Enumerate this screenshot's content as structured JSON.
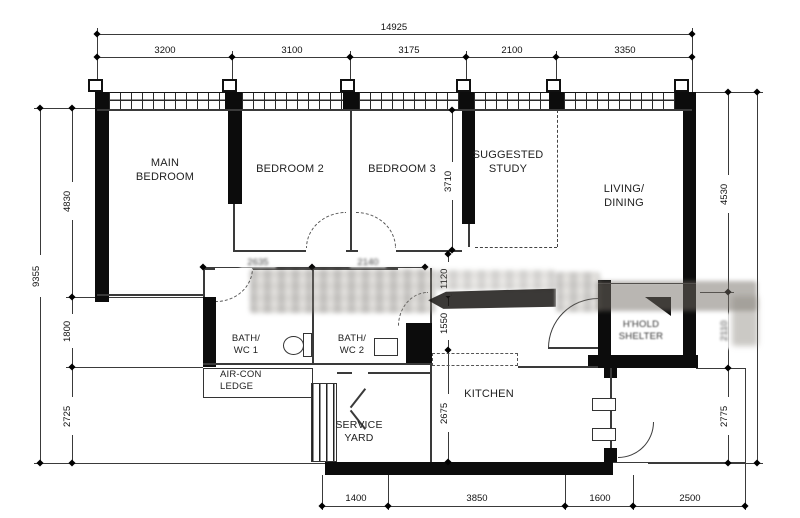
{
  "rooms": {
    "main_bedroom": "MAIN BEDROOM",
    "bedroom_2": "BEDROOM 2",
    "bedroom_3": "BEDROOM 3",
    "suggested_study": "SUGGESTED STUDY",
    "living_dining": "LIVING/ DINING",
    "bath_wc_1": "BATH/ WC 1",
    "bath_wc_2": "BATH/ WC 2",
    "aircon_ledge": "AIR-CON LEDGE",
    "service_yard": "SERVICE YARD",
    "kitchen": "KITCHEN",
    "household_shelter": "H'HOLD SHELTER"
  },
  "dims": {
    "overall_width": "14925",
    "top_segments": [
      "3200",
      "3100",
      "3175",
      "2100",
      "3350"
    ],
    "overall_height": "9355",
    "left_segments": [
      "4830",
      "1800",
      "2725"
    ],
    "right_segments": [
      "4530",
      "2110",
      "2775"
    ],
    "bottom_segments": [
      "1400",
      "3850",
      "1600",
      "2500"
    ],
    "bedroom3_depth": "3710",
    "hall_upper": "1120",
    "hall_lower": "1550",
    "kitchen_depth": "2675",
    "mid_horizontal": [
      "2635",
      "2140"
    ]
  }
}
